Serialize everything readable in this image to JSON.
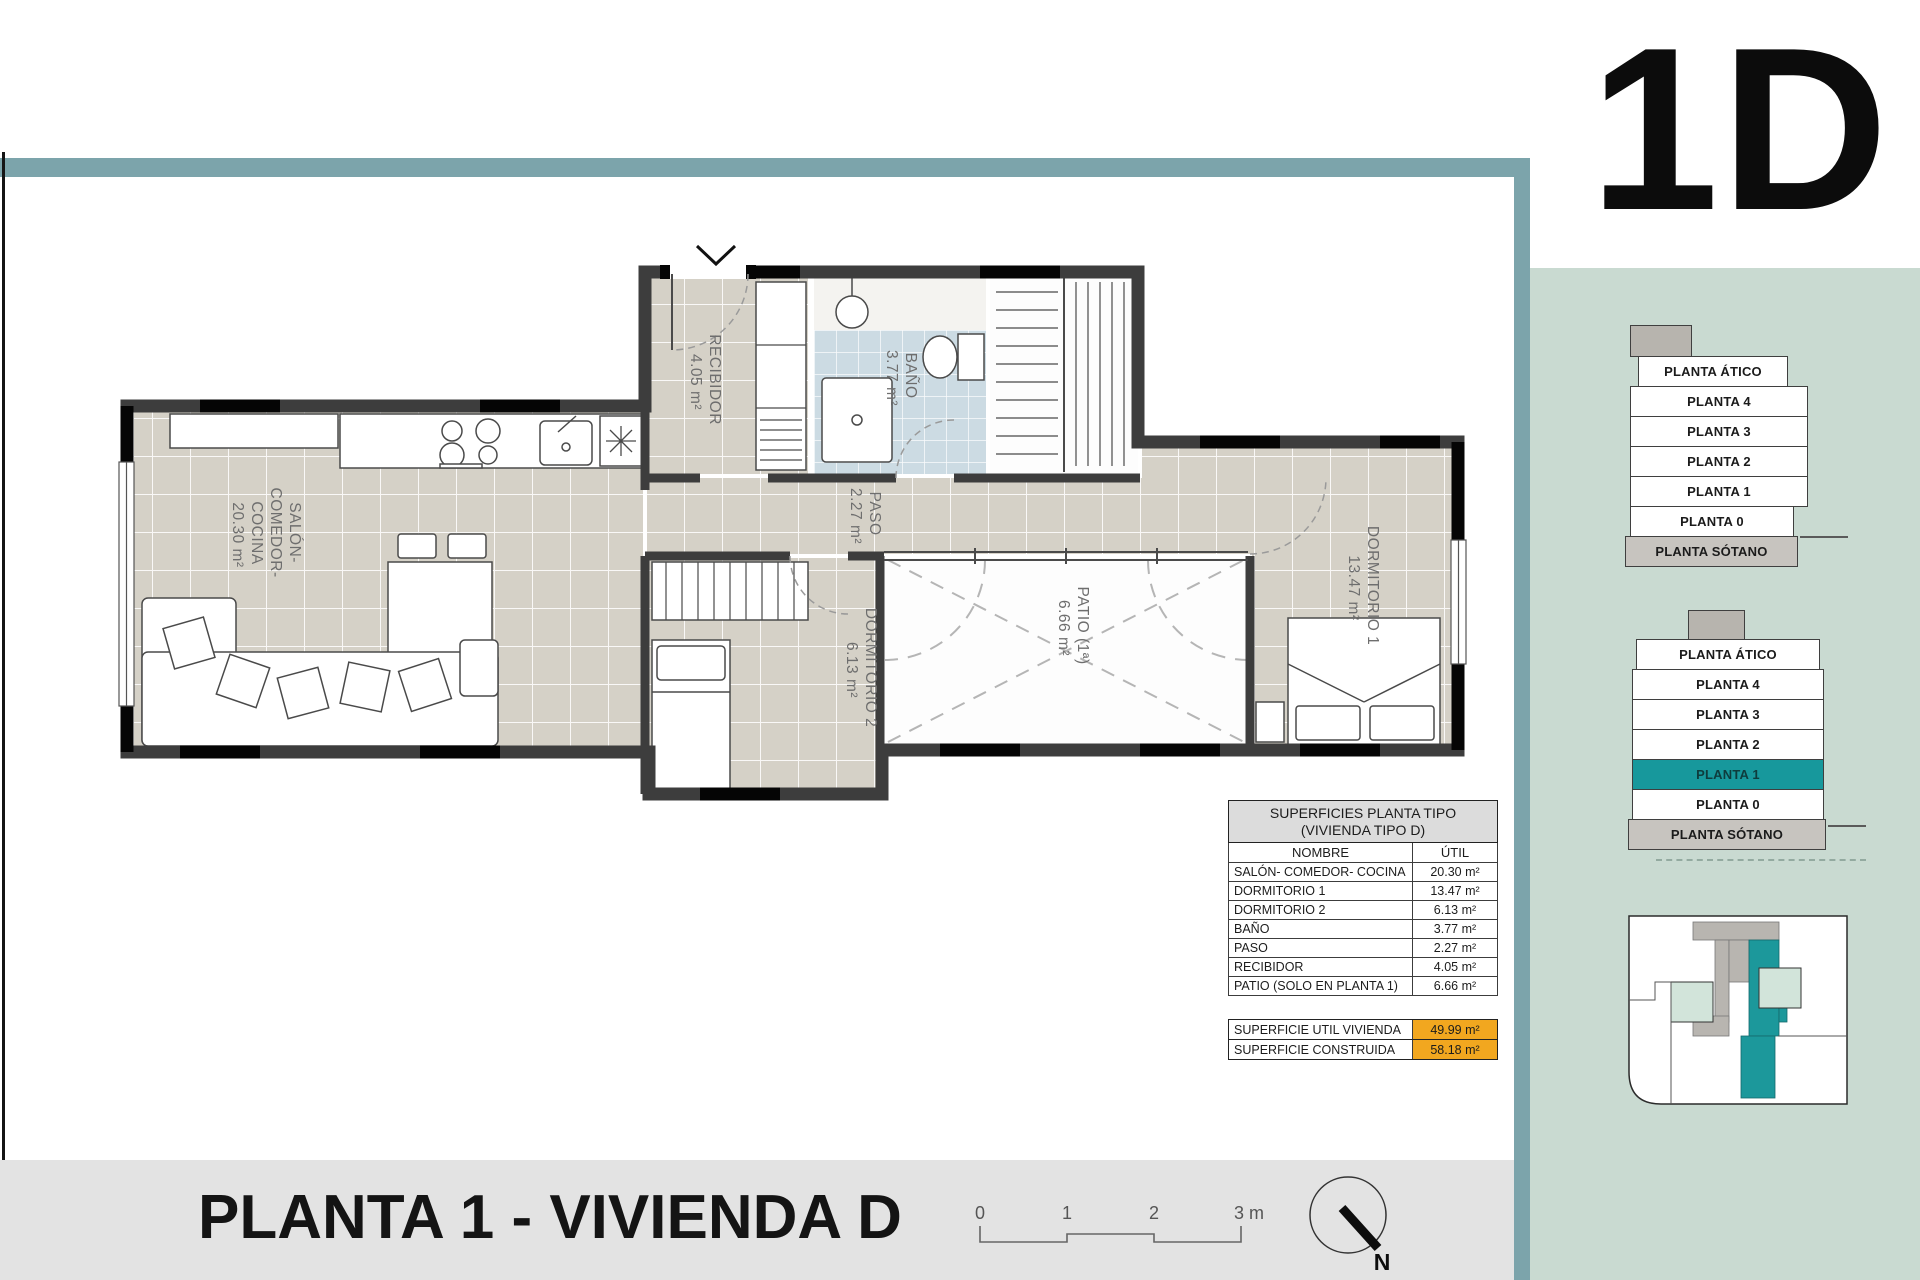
{
  "page": {
    "unit_label": "1D",
    "title": "PLANTA 1 - VIVIENDA D"
  },
  "plan": {
    "rooms": {
      "salon": {
        "line1": "SALÓN-",
        "line2": "COMEDOR-",
        "line3": "COCINA",
        "area": "20.30 m²"
      },
      "recibidor": {
        "name": "RECIBIDOR",
        "area": "4.05 m²"
      },
      "bano": {
        "name": "BAÑO",
        "area": "3.77 m²"
      },
      "paso": {
        "name": "PASO",
        "area": "2.27 m²"
      },
      "dormitorio2": {
        "name": "DORMITORIO 2",
        "area": "6.13 m²"
      },
      "patio": {
        "name": "PATIO (1ª)",
        "area": "6.66 m²"
      },
      "dormitorio1": {
        "name": "DORMITORIO 1",
        "area": "13.47 m²"
      }
    }
  },
  "table": {
    "title_line1": "SUPERFICIES PLANTA TIPO",
    "title_line2": "(VIVIENDA TIPO D)",
    "col_name": "NOMBRE",
    "col_util": "ÚTIL",
    "rows": [
      {
        "name": "SALÓN- COMEDOR- COCINA",
        "util": "20.30 m²"
      },
      {
        "name": "DORMITORIO 1",
        "util": "13.47 m²"
      },
      {
        "name": "DORMITORIO 2",
        "util": "6.13 m²"
      },
      {
        "name": "BAÑO",
        "util": "3.77 m²"
      },
      {
        "name": "PASO",
        "util": "2.27 m²"
      },
      {
        "name": "RECIBIDOR",
        "util": "4.05 m²"
      },
      {
        "name": "PATIO (SOLO EN PLANTA 1)",
        "util": "6.66 m²"
      }
    ],
    "totals": [
      {
        "name": "SUPERFICIE UTIL VIVIENDA",
        "util": "49.99 m²"
      },
      {
        "name": "SUPERFICIE CONSTRUIDA",
        "util": "58.18 m²"
      }
    ]
  },
  "sidebar": {
    "stack_plain": {
      "floors": [
        "PLANTA ÁTICO",
        "PLANTA 4",
        "PLANTA 3",
        "PLANTA 2",
        "PLANTA 1",
        "PLANTA 0",
        "PLANTA SÓTANO"
      ]
    },
    "stack_highlight": {
      "floors": [
        "PLANTA ÁTICO",
        "PLANTA 4",
        "PLANTA 3",
        "PLANTA 2",
        "PLANTA 1",
        "PLANTA 0",
        "PLANTA SÓTANO"
      ],
      "highlighted_floor": "PLANTA 1"
    }
  },
  "footer": {
    "scale_ticks": [
      "0",
      "1",
      "2",
      "3 m"
    ],
    "north_label": "N"
  },
  "colors": {
    "accent_teal": "#17989c",
    "frame_teal": "#7ca4ab",
    "sidebar_green": "#c9dad1",
    "highlight_orange": "#f2a71f",
    "wall_gray": "#3d3d3d",
    "floor_beige": "#d5d1c7",
    "bath_blue": "#ccdbe3",
    "bottom_strip": "#e3e3e3"
  }
}
